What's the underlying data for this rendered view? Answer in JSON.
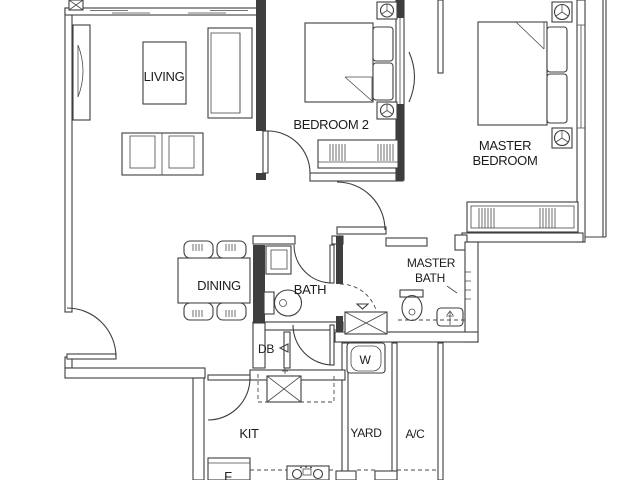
{
  "document": {
    "type": "apartment-floor-plan",
    "style": "black-and-white architectural line drawing, 2-bedroom unit"
  },
  "colors": {
    "background": "#ffffff",
    "wall_line": "#3e3e3e",
    "text": "#1c1c1c"
  },
  "rooms": {
    "living": {
      "label": "LIVING"
    },
    "bedroom2": {
      "label": "BEDROOM 2"
    },
    "master_bedroom": {
      "line1": "MASTER",
      "line2": "BEDROOM"
    },
    "dining": {
      "label": "DINING"
    },
    "bath": {
      "label": "BATH"
    },
    "master_bath": {
      "line1": "MASTER",
      "line2": "BATH"
    },
    "kitchen": {
      "label": "KIT"
    },
    "yard": {
      "label": "YARD"
    },
    "ac_ledge": {
      "label": "A/C"
    },
    "db": {
      "label": "DB"
    }
  },
  "appliances": {
    "washer": {
      "label": "W"
    },
    "fridge": {
      "label": "F"
    }
  },
  "symbols": {
    "fan": "ceiling-fan-symbol",
    "column": "column-x-symbol",
    "shower": "shower-cross-symbol"
  }
}
